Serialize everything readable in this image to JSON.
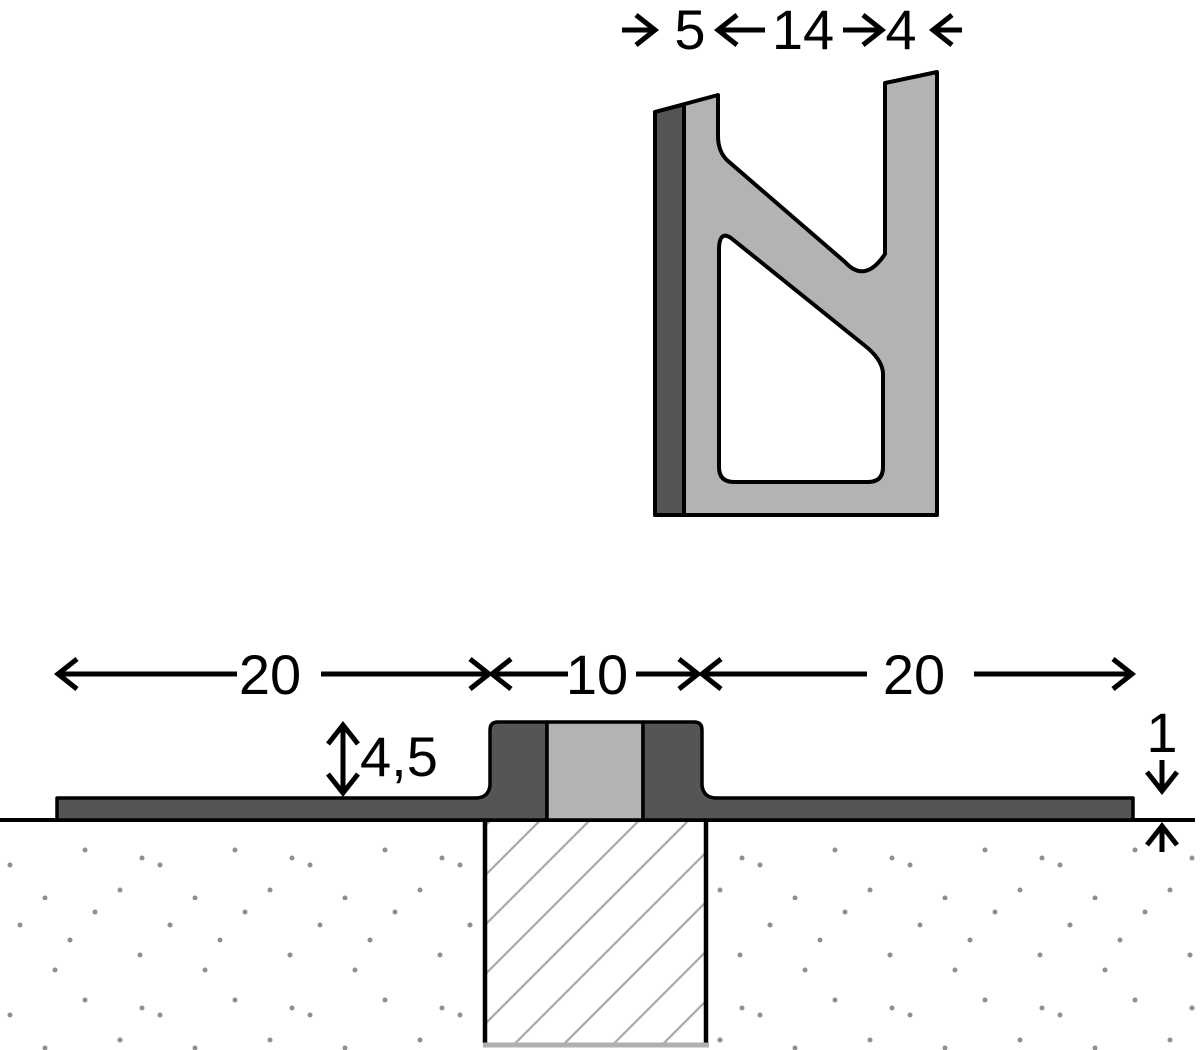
{
  "drawing": {
    "profile_view": {
      "dim_left_leg": "5",
      "dim_gap": "14",
      "dim_right_leg": "4"
    },
    "installed_view": {
      "dim_left_flange": "20",
      "dim_joint_width": "10",
      "dim_right_flange": "20",
      "dim_profile_height": "4,5",
      "dim_flange_thickness": "1"
    },
    "colors": {
      "profile_light": "#b3b3b3",
      "profile_dark": "#555555",
      "outline": "#000000",
      "hatch_line": "#a8a8a8",
      "hatch_base_line": "#b0b0b0",
      "stipple_dot": "#8f8f8f",
      "background": "#ffffff"
    }
  }
}
